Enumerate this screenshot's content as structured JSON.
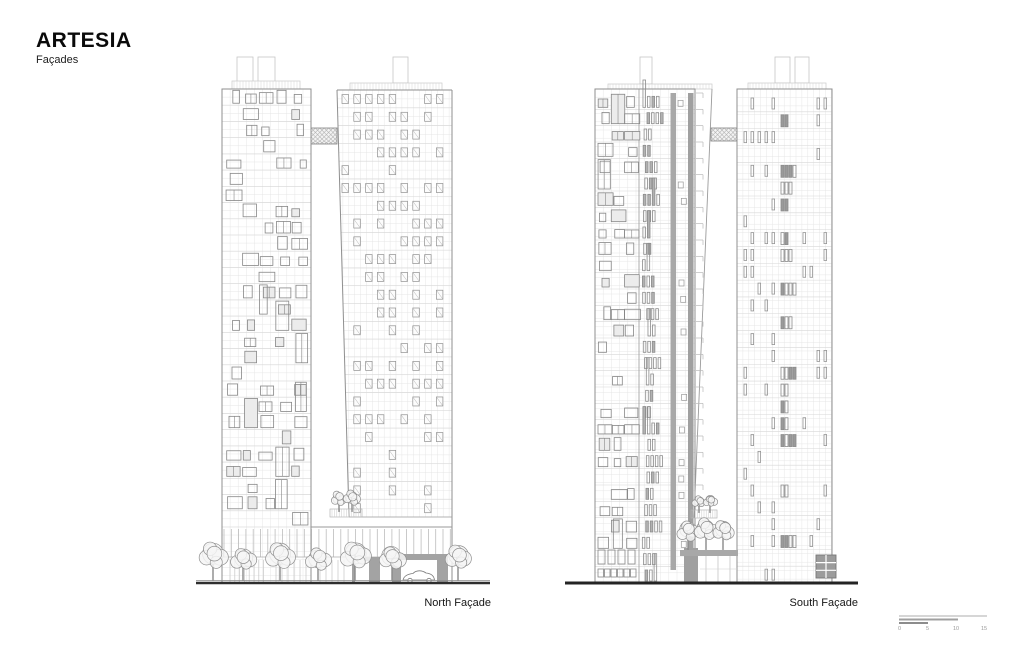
{
  "title": {
    "project": "ARTESIA",
    "sheet": "Façades"
  },
  "drawings": {
    "north": {
      "label": "North Façade"
    },
    "south": {
      "label": "South Façade"
    }
  },
  "scale_bar": {
    "ticks": [
      "0",
      "5",
      "10",
      "15"
    ]
  },
  "colors": {
    "paper": "#ffffff",
    "ink": "#0a0a0a",
    "outline": "#8f8f8f",
    "grid": "#e4e4e4",
    "floorline": "#d7d7d7",
    "frame": "#878787",
    "fill_gray": "#a3a3a3",
    "band_gray": "#a8a8a8",
    "hatch": "#b2b2b2",
    "ground": "#2e2e2e",
    "tree": "#8f8f8f"
  }
}
